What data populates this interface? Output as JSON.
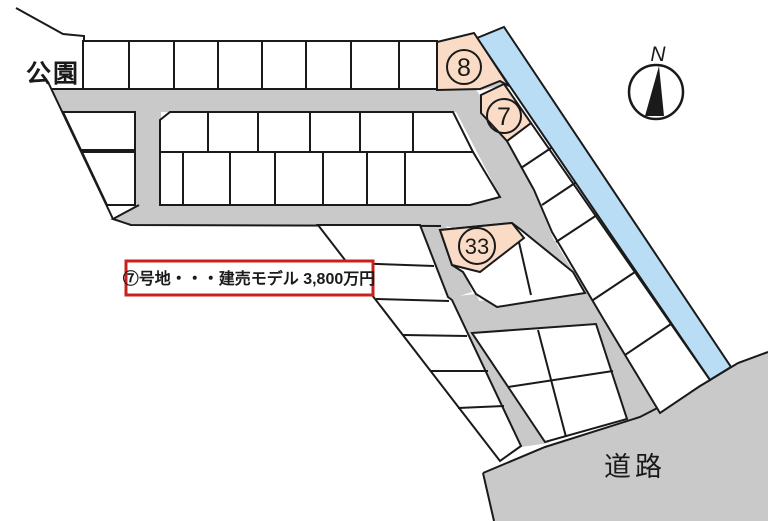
{
  "map_labels": {
    "park": "公園",
    "road": "道路",
    "compass_north": "N"
  },
  "lots": {
    "lot8_number": "8",
    "lot7_number": "7",
    "lot33_number": "33"
  },
  "price_note": {
    "text": "⑦号地・・・建売モデル 3,800万円"
  },
  "colors": {
    "road_gray": "#c9c9c9",
    "water_blue": "#b9ddf5",
    "lot_highlight_peach": "#fadcc6",
    "note_red": "#c9201d",
    "line_black": "#1a1a1a",
    "lot_white": "#ffffff"
  }
}
